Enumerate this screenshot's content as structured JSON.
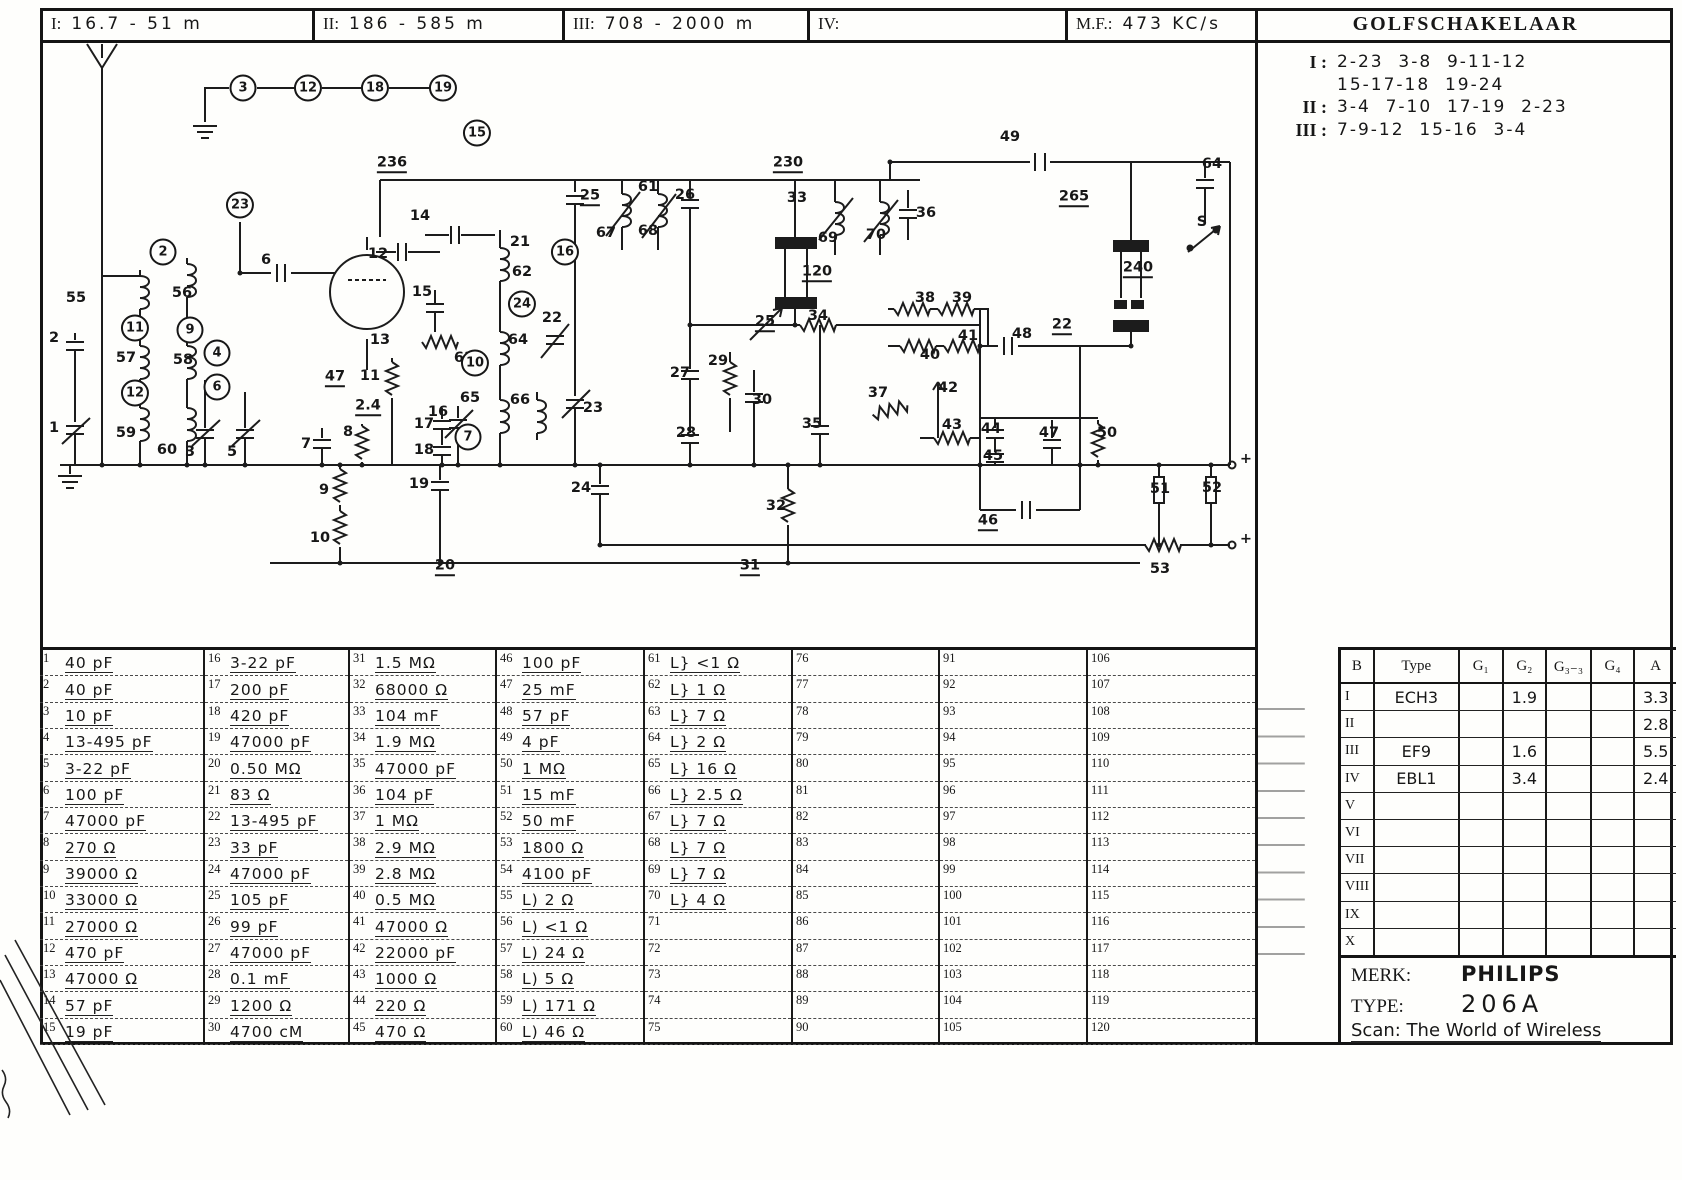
{
  "header": {
    "bands": [
      {
        "label": "I:",
        "value": "16.7 - 51 m"
      },
      {
        "label": "II:",
        "value": "186 - 585 m"
      },
      {
        "label": "III:",
        "value": "708 - 2000 m"
      },
      {
        "label": "IV:",
        "value": ""
      }
    ],
    "mf_label": "M.F.:",
    "mf_value": "473 KC/s",
    "golfschakelaar_title": "GOLFSCHAKELAAR"
  },
  "golfschakelaar": {
    "lines": [
      {
        "roman": "I :",
        "text": "2-23  3-8  9-11-12"
      },
      {
        "roman": "",
        "text": "15-17-18  19-24"
      },
      {
        "roman": "II :",
        "text": "3-4  7-10  17-19  2-23"
      },
      {
        "roman": "III :",
        "text": "7-9-12  15-16  3-4"
      }
    ]
  },
  "parts": {
    "first_number": 1,
    "last_number": 120,
    "values": [
      "40 pF",
      "40 pF",
      "10 pF",
      "13-495 pF",
      "3-22 pF",
      "100 pF",
      "47000 pF",
      "270 Ω",
      "39000 Ω",
      "33000 Ω",
      "27000 Ω",
      "470 pF",
      "47000 Ω",
      "57 pF",
      "19 pF",
      "3-22 pF",
      "200 pF",
      "420 pF",
      "47000 pF",
      "0.50 MΩ",
      "83 Ω",
      "13-495 pF",
      "33 pF",
      "47000 pF",
      "105 pF",
      "99 pF",
      "47000 pF",
      "0.1 mF",
      "1200 Ω",
      "4700 cM",
      "1.5 MΩ",
      "68000 Ω",
      "104 mF",
      "1.9 MΩ",
      "47000 pF",
      "104 pF",
      "1 MΩ",
      "2.9 MΩ",
      "2.8 MΩ",
      "0.5 MΩ",
      "47000 Ω",
      "22000 pF",
      "1000 Ω",
      "220 Ω",
      "470 Ω",
      "100 pF",
      "25 mF",
      "57 pF",
      "4 pF",
      "1 MΩ",
      "15 mF",
      "50 mF",
      "1800 Ω",
      "4100 pF",
      "L) 2 Ω",
      "L) <1 Ω",
      "L) 24 Ω",
      "L) 5 Ω",
      "L) 171 Ω",
      "L) 46 Ω",
      "L} <1 Ω",
      "L} 1 Ω",
      "L} 7 Ω",
      "L} 2 Ω",
      "L} 16 Ω",
      "L} 2.5 Ω",
      "L} 7 Ω",
      "L} 7 Ω",
      "L} 7 Ω",
      "L} 4 Ω",
      "",
      "",
      "",
      "",
      "",
      "",
      "",
      "",
      "",
      "",
      "",
      "",
      "",
      "",
      "",
      "",
      "",
      "",
      "",
      "",
      "",
      "",
      "",
      "",
      "",
      "",
      "",
      "",
      "",
      "",
      "",
      "",
      "",
      "",
      "",
      "",
      "",
      "",
      "",
      "",
      "",
      "",
      "",
      "",
      "",
      "",
      "",
      "",
      "",
      ""
    ]
  },
  "tubes": {
    "headers": [
      "B",
      "Type",
      "G₁",
      "G₂",
      "G₃₋₃",
      "G₄",
      "A"
    ],
    "rows": [
      [
        "I",
        "ECH3",
        "",
        "1.9",
        "",
        "",
        "3.3"
      ],
      [
        "II",
        "",
        "",
        "",
        "",
        "",
        "2.8"
      ],
      [
        "III",
        "EF9",
        "",
        "1.6",
        "",
        "",
        "5.5"
      ],
      [
        "IV",
        "EBL1",
        "",
        "3.4",
        "",
        "",
        "2.4"
      ],
      [
        "V",
        "",
        "",
        "",
        "",
        "",
        ""
      ],
      [
        "VI",
        "",
        "",
        "",
        "",
        "",
        ""
      ],
      [
        "VII",
        "",
        "",
        "",
        "",
        "",
        ""
      ],
      [
        "VIII",
        "",
        "",
        "",
        "",
        "",
        ""
      ],
      [
        "IX",
        "",
        "",
        "",
        "",
        "",
        ""
      ],
      [
        "X",
        "",
        "",
        "",
        "",
        "",
        ""
      ]
    ]
  },
  "brand": {
    "merk_label": "MERK:",
    "merk_value": "PHILIPS",
    "type_label": "TYPE:",
    "type_value": "206A",
    "credit": "Scan: The World of Wireless"
  },
  "schematic": {
    "labels": [
      [
        "3",
        203,
        48,
        "c"
      ],
      [
        "12",
        268,
        48,
        "c"
      ],
      [
        "18",
        335,
        48,
        "c"
      ],
      [
        "19",
        403,
        48,
        "c"
      ],
      [
        "23",
        200,
        165,
        "c"
      ],
      [
        "2",
        123,
        212,
        "c"
      ],
      [
        "11",
        95,
        288,
        "c"
      ],
      [
        "9",
        150,
        290,
        "c"
      ],
      [
        "4",
        177,
        313,
        "c"
      ],
      [
        "6",
        177,
        347,
        "c"
      ],
      [
        "12",
        95,
        353,
        "c"
      ],
      [
        "55",
        36,
        258,
        ""
      ],
      [
        "56",
        142,
        253,
        ""
      ],
      [
        "57",
        86,
        318,
        ""
      ],
      [
        "58",
        143,
        320,
        ""
      ],
      [
        "59",
        86,
        393,
        ""
      ],
      [
        "60",
        127,
        410,
        ""
      ],
      [
        "2",
        14,
        298,
        ""
      ],
      [
        "1",
        14,
        388,
        ""
      ],
      [
        "3",
        150,
        412,
        ""
      ],
      [
        "5",
        192,
        412,
        ""
      ],
      [
        "6",
        226,
        220,
        ""
      ],
      [
        "236",
        352,
        124,
        "u"
      ],
      [
        "14",
        380,
        176,
        ""
      ],
      [
        "12",
        338,
        214,
        ""
      ],
      [
        "15",
        382,
        252,
        ""
      ],
      [
        "13",
        340,
        300,
        ""
      ],
      [
        "11",
        330,
        336,
        ""
      ],
      [
        "47",
        295,
        338,
        "u"
      ],
      [
        "2.4",
        328,
        367,
        "u"
      ],
      [
        "16",
        398,
        372,
        ""
      ],
      [
        "63",
        424,
        318,
        ""
      ],
      [
        "15",
        437,
        93,
        "c"
      ],
      [
        "16",
        525,
        212,
        "c"
      ],
      [
        "21",
        480,
        202,
        ""
      ],
      [
        "62",
        482,
        232,
        ""
      ],
      [
        "24",
        482,
        264,
        "c"
      ],
      [
        "64",
        478,
        300,
        ""
      ],
      [
        "22",
        512,
        278,
        ""
      ],
      [
        "10",
        435,
        323,
        "c"
      ],
      [
        "65",
        430,
        358,
        ""
      ],
      [
        "66",
        480,
        360,
        ""
      ],
      [
        "7",
        428,
        397,
        "c"
      ],
      [
        "17",
        384,
        384,
        ""
      ],
      [
        "18",
        384,
        410,
        ""
      ],
      [
        "7",
        266,
        404,
        ""
      ],
      [
        "8",
        308,
        392,
        ""
      ],
      [
        "9",
        284,
        450,
        ""
      ],
      [
        "10",
        280,
        498,
        ""
      ],
      [
        "19",
        379,
        444,
        ""
      ],
      [
        "20",
        405,
        527,
        "u"
      ],
      [
        "23",
        553,
        368,
        ""
      ],
      [
        "24",
        541,
        448,
        ""
      ],
      [
        "25",
        550,
        157,
        "u"
      ],
      [
        "61",
        608,
        147,
        ""
      ],
      [
        "67",
        566,
        193,
        ""
      ],
      [
        "68",
        608,
        191,
        ""
      ],
      [
        "26",
        645,
        155,
        ""
      ],
      [
        "230",
        748,
        124,
        "u"
      ],
      [
        "33",
        757,
        158,
        ""
      ],
      [
        "69",
        788,
        198,
        ""
      ],
      [
        "70",
        836,
        195,
        ""
      ],
      [
        "36",
        886,
        173,
        ""
      ],
      [
        "49",
        970,
        97,
        ""
      ],
      [
        "64",
        1172,
        124,
        ""
      ],
      [
        "265",
        1034,
        158,
        "u"
      ],
      [
        "S",
        1162,
        182,
        ""
      ],
      [
        "240",
        1098,
        229,
        "u"
      ],
      [
        "120",
        777,
        233,
        "u"
      ],
      [
        "25",
        725,
        283,
        "u"
      ],
      [
        "34",
        778,
        276,
        ""
      ],
      [
        "38",
        885,
        258,
        ""
      ],
      [
        "39",
        922,
        258,
        ""
      ],
      [
        "40",
        890,
        315,
        ""
      ],
      [
        "41",
        928,
        296,
        ""
      ],
      [
        "48",
        982,
        294,
        ""
      ],
      [
        "22",
        1022,
        286,
        "u"
      ],
      [
        "27",
        640,
        333,
        ""
      ],
      [
        "29",
        678,
        321,
        ""
      ],
      [
        "30",
        722,
        360,
        ""
      ],
      [
        "28",
        646,
        393,
        ""
      ],
      [
        "35",
        772,
        384,
        ""
      ],
      [
        "37",
        838,
        353,
        ""
      ],
      [
        "42",
        908,
        348,
        ""
      ],
      [
        "43",
        912,
        385,
        ""
      ],
      [
        "44",
        951,
        389,
        ""
      ],
      [
        "45",
        953,
        416,
        ""
      ],
      [
        "47",
        1009,
        393,
        ""
      ],
      [
        "50",
        1067,
        393,
        ""
      ],
      [
        "46",
        948,
        482,
        "u"
      ],
      [
        "32",
        736,
        466,
        ""
      ],
      [
        "31",
        710,
        527,
        "u"
      ],
      [
        "51",
        1120,
        449,
        ""
      ],
      [
        "52",
        1172,
        448,
        ""
      ],
      [
        "53",
        1120,
        529,
        ""
      ],
      [
        "+",
        1206,
        419,
        ""
      ],
      [
        "+",
        1206,
        499,
        ""
      ]
    ]
  }
}
